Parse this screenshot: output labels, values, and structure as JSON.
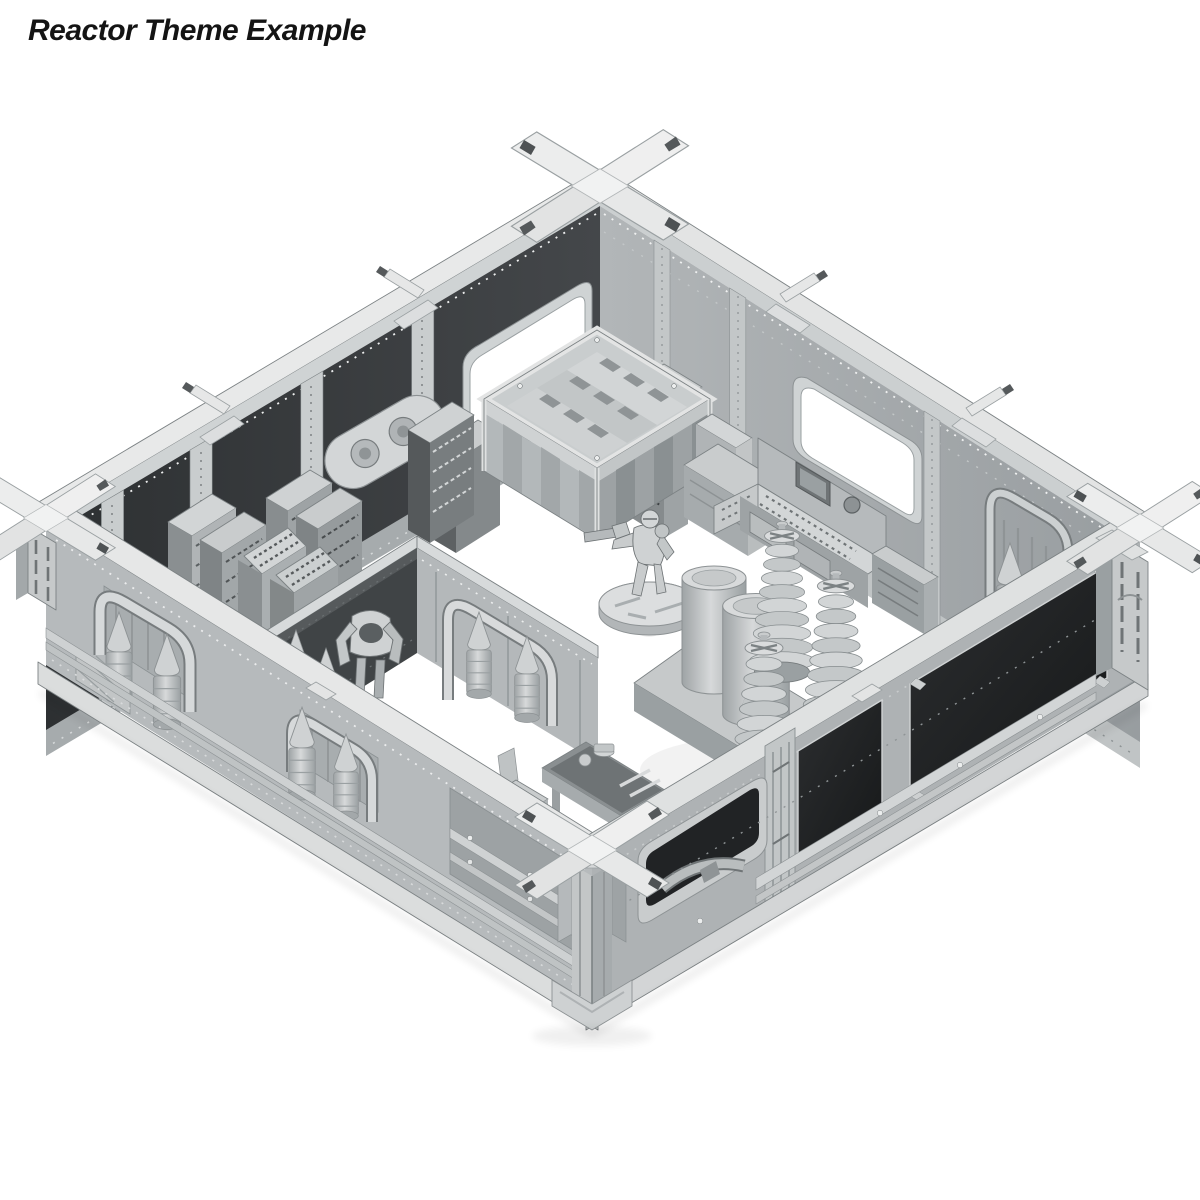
{
  "header": {
    "title": "Reactor Theme Example"
  },
  "palette": {
    "bg": "#ffffff",
    "ink": "#141414",
    "top_light": "#e8e9e9",
    "trim": "#d6d9da",
    "face_dark": "#3b3e40",
    "face_light": "#a9aeb0",
    "panel_dark": "#232527",
    "metal": "#b5b9bb",
    "shade": "#8d9294",
    "line": "#7c8284"
  },
  "scene": {
    "objects": [
      "modular-wall-room",
      "corner-cross-connectors",
      "tall-wall-window",
      "storage-crate",
      "server-rack-consoles",
      "oval-wall-vent",
      "control-console",
      "reactor-coil-bank",
      "power-armor-rack",
      "pipe-and-canister-wall",
      "tool-workbench",
      "hero-miniature",
      "low-wall-window"
    ]
  }
}
